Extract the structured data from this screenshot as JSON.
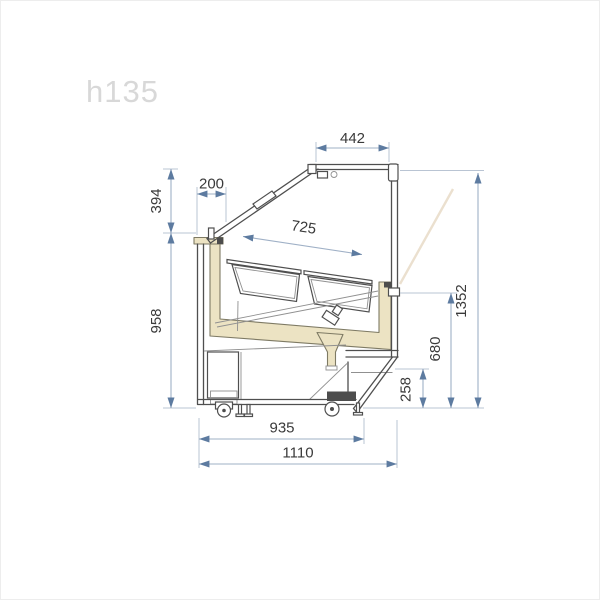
{
  "watermark": "h135",
  "palette": {
    "background": "#ffffff",
    "drawing_outline": "#4f4f4f",
    "insulation_fill": "#ece3c3",
    "insulation_stroke": "#7e7a64",
    "dimension_line": "#9fb0c6",
    "dimension_arrow": "#5d7ba0",
    "dimension_text": "#3a3a3a",
    "watermark_color": "#d8d8d8"
  },
  "dimensions": {
    "top_width": "442",
    "glass_offset": "200",
    "upper_height": "394",
    "display_width": "725",
    "body_height": "958",
    "total_height": "1352",
    "rear_opening_height": "680",
    "base_height": "258",
    "base_width": "935",
    "total_depth": "1110"
  }
}
